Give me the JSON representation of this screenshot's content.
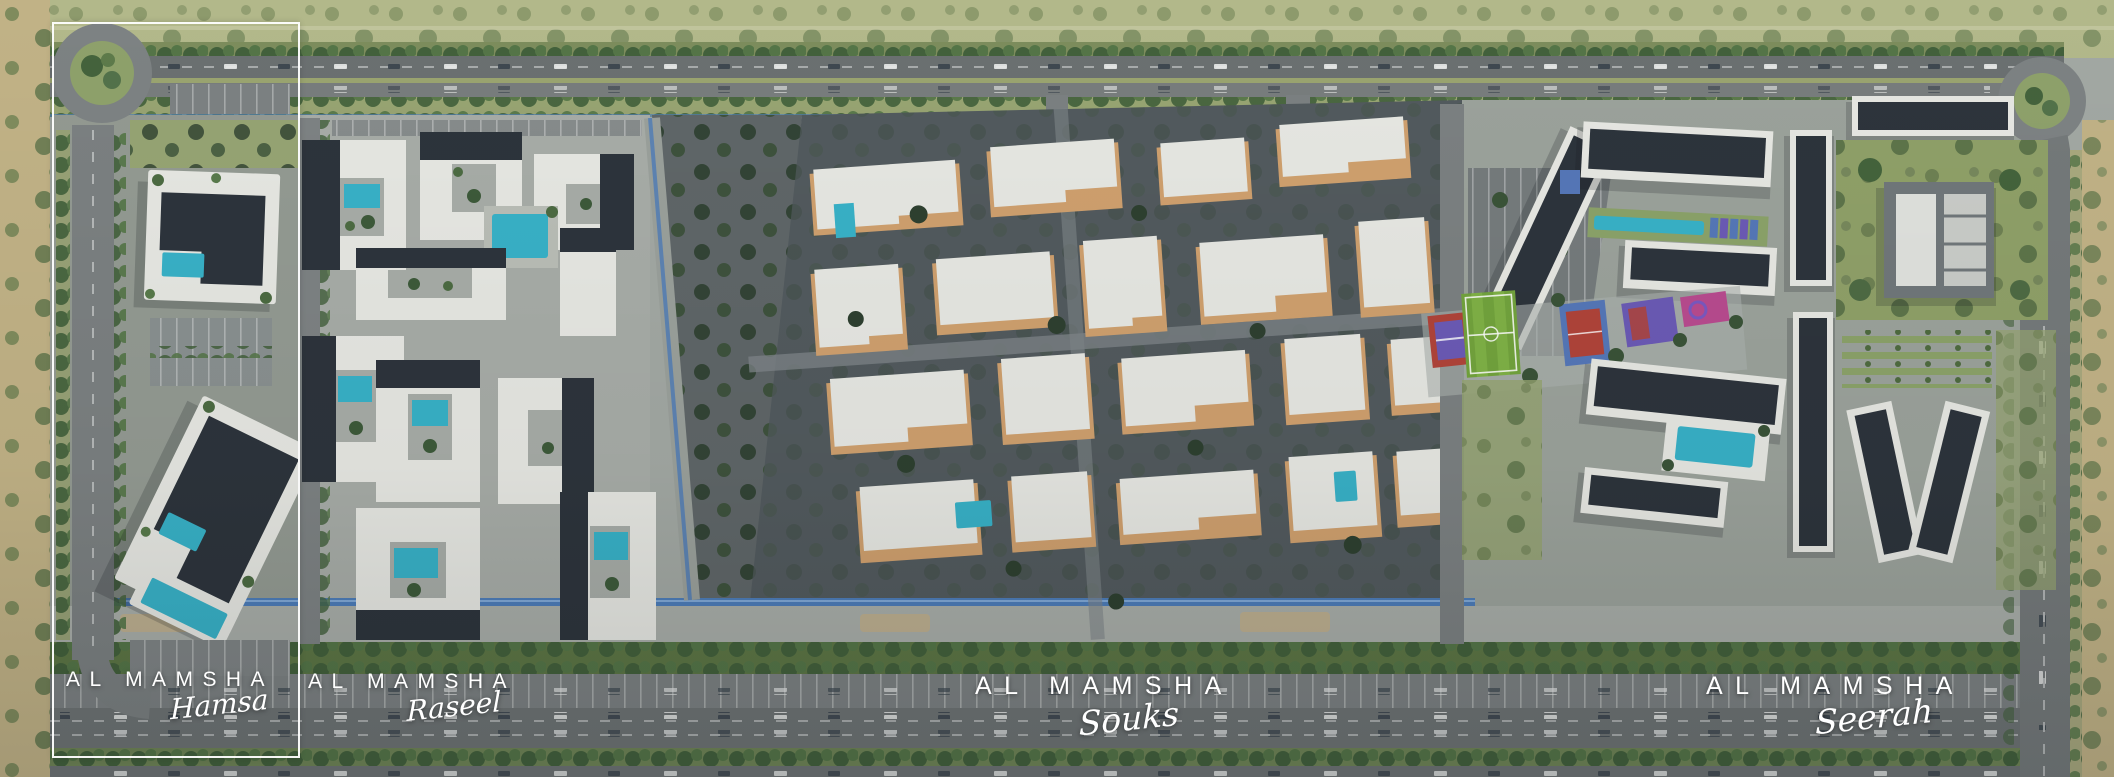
{
  "scene": {
    "type": "masterplan-aerial-render",
    "project": "AL MAMSHA"
  },
  "districts": [
    {
      "id": "hamsa",
      "brand": "AL MAMSHA",
      "name": "Hamsa",
      "highlighted": true
    },
    {
      "id": "raseel",
      "brand": "AL MAMSHA",
      "name": "Raseel",
      "highlighted": false
    },
    {
      "id": "souks",
      "brand": "AL MAMSHA",
      "name": "Souks",
      "highlighted": false
    },
    {
      "id": "seerah",
      "brand": "AL MAMSHA",
      "name": "Seerah",
      "highlighted": false
    }
  ],
  "palette": {
    "label_text": "#ffffff",
    "pool": "#38b1c7",
    "pitch": "#7aa83f",
    "court_red": "#b0443a",
    "court_blue": "#5577b8",
    "court_purple": "#6b5ab5",
    "court_magenta": "#b84b8f",
    "building_light": "#e6e7e2",
    "roof_dark": "#2d343c",
    "souks_accent": "#cfa06e",
    "souks_ground": "#525a5e",
    "asphalt": "#6e7374",
    "concrete": "#a8ada8",
    "grass_field": "#b2b88a",
    "sand": "#c1b286",
    "tree_dark": "#3a5338",
    "canal_blue": "#4d7cb8"
  }
}
